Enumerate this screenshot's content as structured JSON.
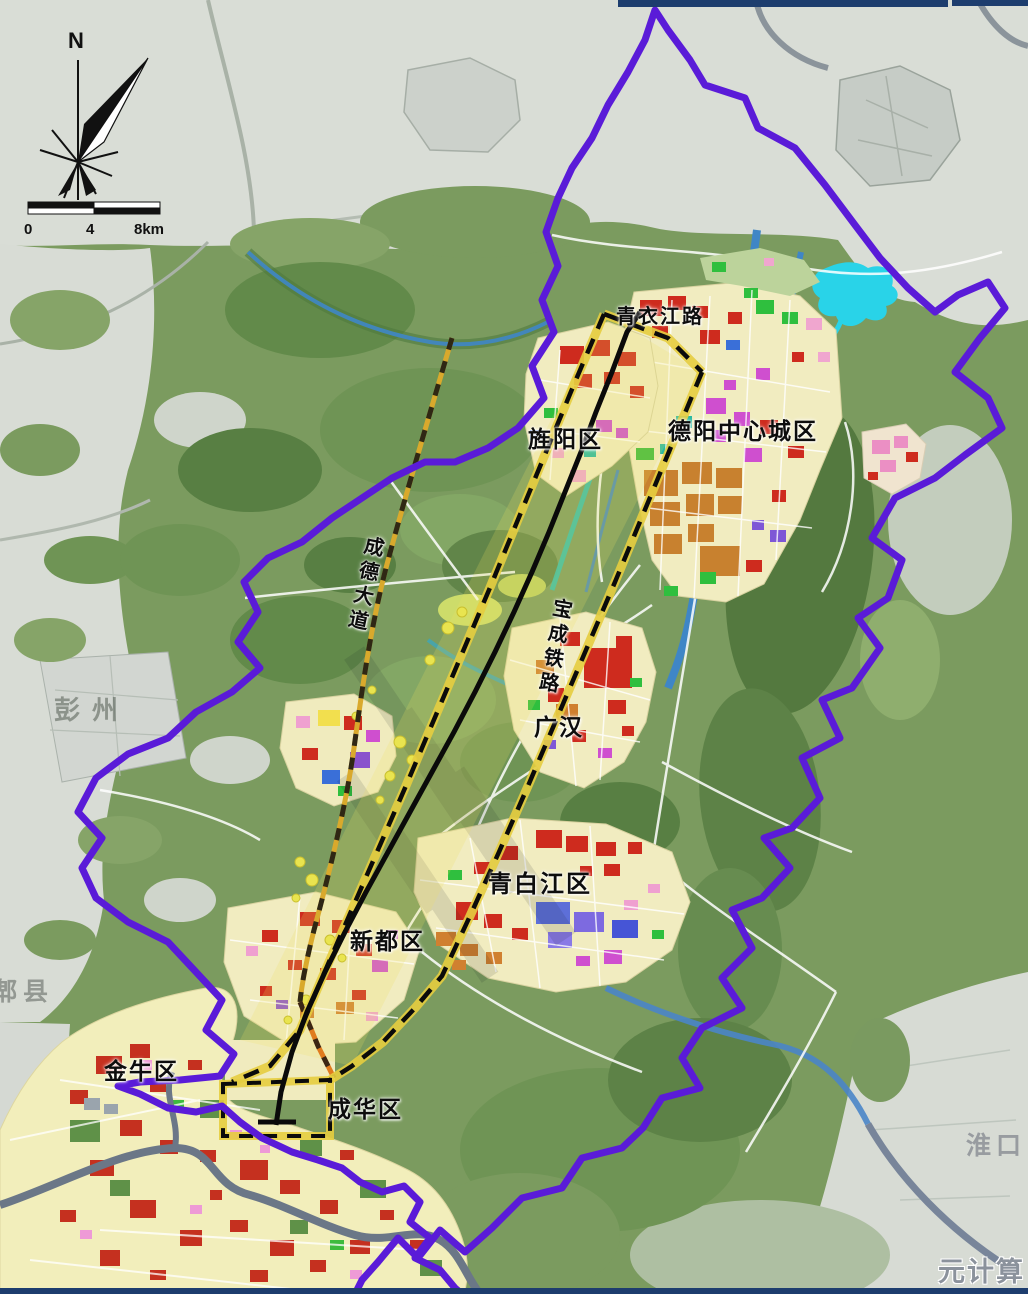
{
  "map": {
    "compass": {
      "north_label": "N"
    },
    "scale_bar": {
      "ticks": [
        "0",
        "4",
        "8km"
      ]
    },
    "roads": {
      "qingyijiang_road": "青衣江路",
      "chengde_avenue": "成德大道",
      "baocheng_railway": "宝成铁路"
    },
    "districts": {
      "deyang_center": "德阳中心城区",
      "jingyang": "旌阳区",
      "guanghan": "广汉",
      "qingbaijiang": "青白江区",
      "xindu": "新都区",
      "jinniu": "金牛区",
      "chenghua": "成华区"
    },
    "adjacent_places": {
      "pengzhou": "彭州",
      "pixian": "郫县",
      "huaikou": "淮口"
    },
    "watermark": "元计算",
    "colors": {
      "boundary_purple": "#5a1bd8",
      "corridor_yellow": "#e5cd3f",
      "railway_black": "#111111",
      "river_blue": "#3f86c6",
      "lake_cyan": "#29d3e8",
      "urban_cream": "#f1ecc0",
      "urban_red": "#c9311f",
      "plain_green": "#7b9b5f",
      "terrain_gray": "#d8dcd5"
    }
  }
}
